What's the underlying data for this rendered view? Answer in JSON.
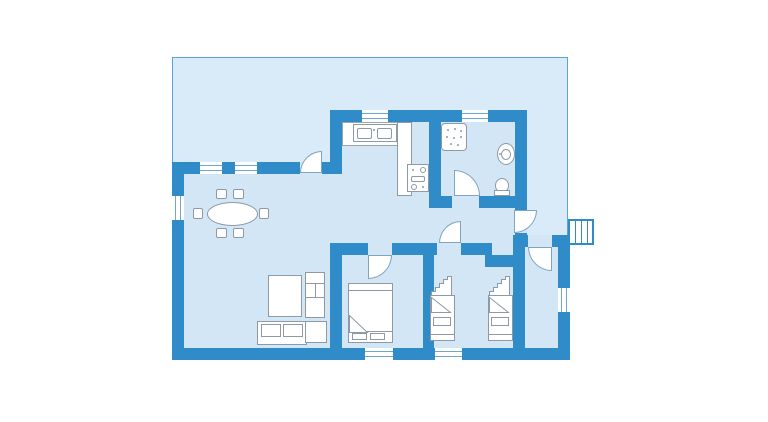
{
  "plan": {
    "type": "floor-plan",
    "colors": {
      "wall": "#2f8cc9",
      "terrace_fill": "#d9eaf8",
      "terrace_border": "#59a4d6",
      "room_fill": "#d3e6f6",
      "furniture_fill": "#ffffff",
      "furniture_stroke": "#8d9aa5",
      "door_stroke": "#7fa6c0",
      "background": "#ffffff"
    },
    "rooms": [
      {
        "id": "terrace",
        "label": "Terrace / garden"
      },
      {
        "id": "living-dining",
        "label": "Living room with dining area"
      },
      {
        "id": "kitchen",
        "label": "Open kitchen"
      },
      {
        "id": "bathroom",
        "label": "Bathroom with shower, washbasin and WC"
      },
      {
        "id": "hallway",
        "label": "Hallway"
      },
      {
        "id": "bedroom-double",
        "label": "Bedroom with double bed"
      },
      {
        "id": "bedroom-singles",
        "label": "Bedroom with two single beds"
      },
      {
        "id": "entry",
        "label": "Entry room"
      }
    ],
    "furniture": [
      {
        "id": "dining-table",
        "label": "Oval dining table with six chairs"
      },
      {
        "id": "sofa",
        "label": "Sofa"
      },
      {
        "id": "living-table",
        "label": "Living room table"
      },
      {
        "id": "wall-unit",
        "label": "Shelf unit"
      },
      {
        "id": "side-table",
        "label": "Side table"
      },
      {
        "id": "kitchen-counter",
        "label": "Kitchen counter with double sink"
      },
      {
        "id": "stove",
        "label": "Stove and oven"
      },
      {
        "id": "shower",
        "label": "Shower"
      },
      {
        "id": "washbasin",
        "label": "Washbasin"
      },
      {
        "id": "toilet",
        "label": "Toilet"
      },
      {
        "id": "double-bed",
        "label": "Double bed"
      },
      {
        "id": "single-bed-left",
        "label": "Single bed with ladder"
      },
      {
        "id": "single-bed-right",
        "label": "Single bed with ladder"
      }
    ],
    "doors": [
      {
        "id": "terrace-door",
        "label": "Terrace door"
      },
      {
        "id": "bathroom-door",
        "label": "Bathroom door"
      },
      {
        "id": "bedroom-double-door",
        "label": "Bedroom door"
      },
      {
        "id": "bedroom-singles-door",
        "label": "Bedroom door"
      },
      {
        "id": "entrance-door",
        "label": "Entrance door"
      },
      {
        "id": "entry-room-door",
        "label": "Entry room door"
      }
    ],
    "windows_count": 8,
    "entrance_steps_count": 4
  }
}
